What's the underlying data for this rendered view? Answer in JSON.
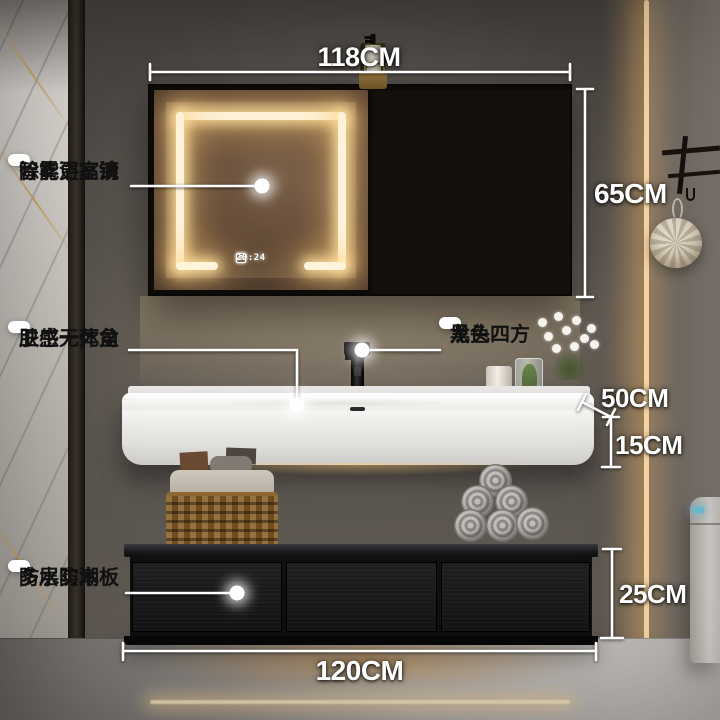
{
  "callouts": {
    "smart_mirror": {
      "line1": "智能浴室镜",
      "line2": "除雾更高清"
    },
    "integrated_basin": {
      "line1": "肤感一体盆",
      "line2": "卫生无死角"
    },
    "black_faucet": {
      "line1": "黑色四方",
      "line2": "龙头"
    },
    "wood_board": {
      "line1": "多层实木板",
      "line2": "防水防潮"
    }
  },
  "dimensions": {
    "mirror_cabinet_width": "118CM",
    "mirror_cabinet_height": "65CM",
    "basin_depth": "50CM",
    "basin_height": "15CM",
    "cabinet_height": "25CM",
    "cabinet_width": "120CM"
  },
  "mirror_display": {
    "clock": "20:24",
    "button1_glyph": "≡",
    "button2_glyph": "◎"
  },
  "colors": {
    "led_warm": "#ffdba6",
    "callout_bg": "#ffffff",
    "callout_text": "#111111",
    "dimension_text": "#ffffff",
    "basin_white": "#f5f4f2",
    "cabinet_black": "#141414",
    "toilet_indicator": "#7ad2ea"
  }
}
